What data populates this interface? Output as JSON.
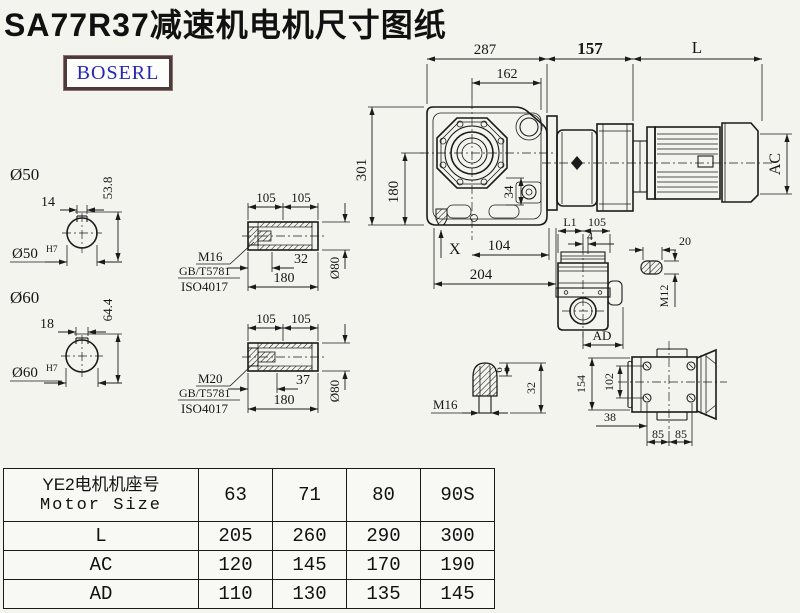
{
  "title": "SA77R37减速机电机尺寸图纸",
  "logo": {
    "text": "BOSERL"
  },
  "colors": {
    "line": "#1b1b1b",
    "background": "#f4f4ef",
    "logo_text": "#2626b4",
    "logo_border": "#4e3a3a"
  },
  "dims": {
    "top": {
      "w287": "287",
      "w162": "162",
      "w157": "157",
      "wL": "L"
    },
    "left": {
      "h301": "301",
      "h180": "180"
    },
    "main": {
      "x_mark": "X",
      "w104": "104",
      "w204": "204",
      "h34": "34",
      "ac": "AC"
    },
    "shaft50": {
      "label": "Ø50",
      "key_w": "14",
      "depth": "53.8",
      "bore": "Ø50",
      "bore_tol": "H7"
    },
    "shaft60": {
      "label": "Ø60",
      "key_w": "18",
      "depth": "64.4",
      "bore": "Ø60",
      "bore_tol": "H7"
    },
    "sec1": {
      "l105a": "105",
      "l105b": "105",
      "thread": "M16",
      "std1": "GB/T5781",
      "std2": "ISO4017",
      "bolt_len": "32",
      "total": "180",
      "dia": "Ø80"
    },
    "sec2": {
      "l105a": "105",
      "l105b": "105",
      "thread": "M20",
      "std1": "GB/T5781",
      "std2": "ISO4017",
      "bolt_len": "37",
      "total": "180",
      "dia": "Ø80"
    },
    "side": {
      "l1": "L1",
      "w105": "105",
      "w4": "4",
      "ad": "AD"
    },
    "plug": {
      "len": "20",
      "thread": "M12"
    },
    "cone": {
      "thread": "M16",
      "d6": "6",
      "d32": "32"
    },
    "top_view": {
      "h154": "154",
      "h102": "102",
      "w38": "38",
      "w85a": "85",
      "w85b": "85"
    }
  },
  "table": {
    "header": {
      "cn": "YE2电机机座号",
      "en": "Motor Size"
    },
    "sizes": [
      "63",
      "71",
      "80",
      "90S"
    ],
    "rows": [
      {
        "label": "L",
        "values": [
          "205",
          "260",
          "290",
          "300"
        ]
      },
      {
        "label": "AC",
        "values": [
          "120",
          "145",
          "170",
          "190"
        ]
      },
      {
        "label": "AD",
        "values": [
          "110",
          "130",
          "135",
          "145"
        ]
      }
    ]
  }
}
